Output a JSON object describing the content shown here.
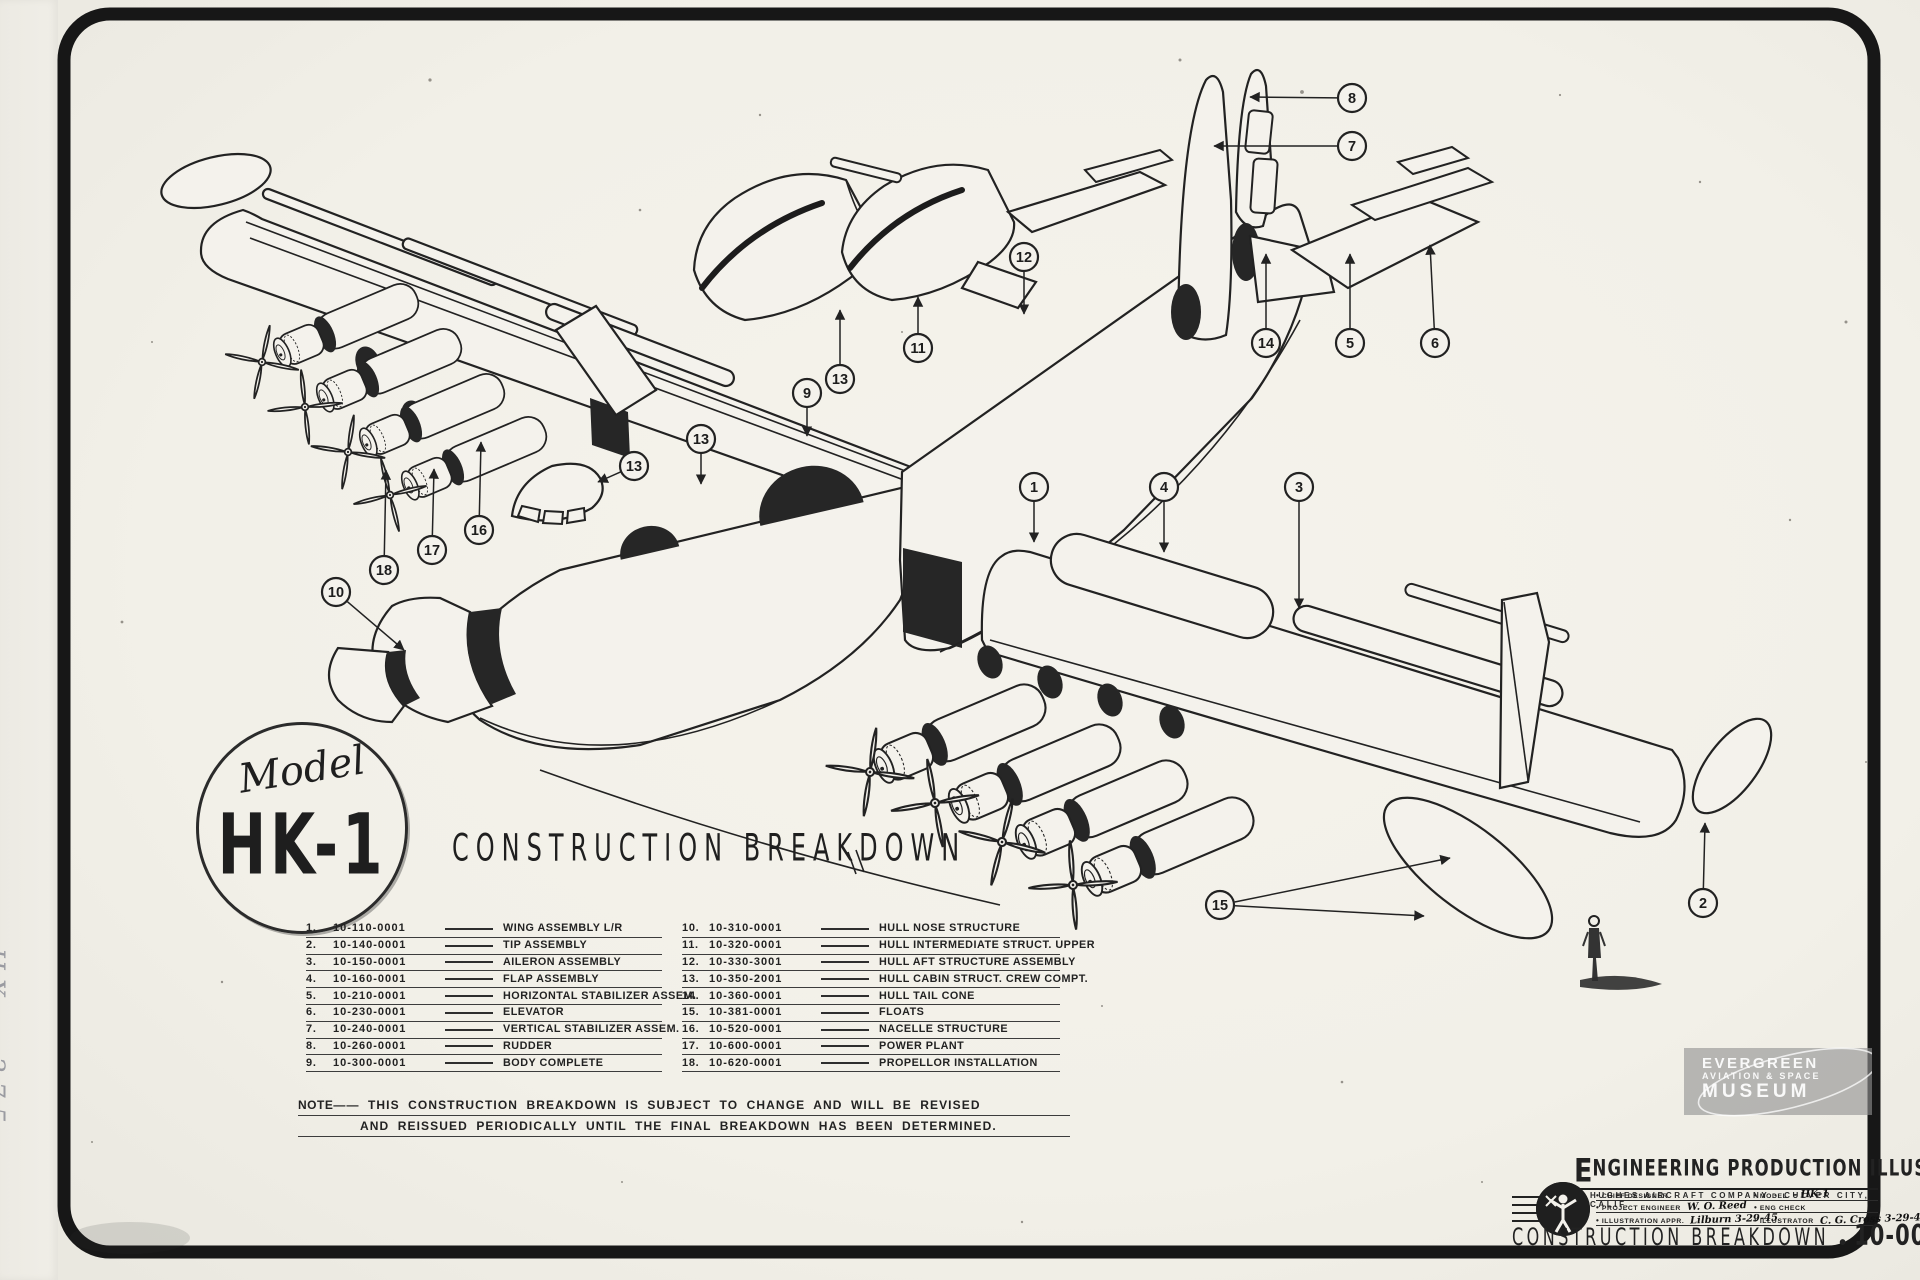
{
  "logo": {
    "model_label": "Model",
    "model_number": "HK-1"
  },
  "headline": "CONSTRUCTION BREAKDOWN",
  "parts_list": {
    "left": [
      {
        "num": "1.",
        "part": "10-110-0001",
        "name": "WING ASSEMBLY L/R"
      },
      {
        "num": "2.",
        "part": "10-140-0001",
        "name": "TIP ASSEMBLY"
      },
      {
        "num": "3.",
        "part": "10-150-0001",
        "name": "AILERON ASSEMBLY"
      },
      {
        "num": "4.",
        "part": "10-160-0001",
        "name": "FLAP ASSEMBLY"
      },
      {
        "num": "5.",
        "part": "10-210-0001",
        "name": "HORIZONTAL STABILIZER ASSEM."
      },
      {
        "num": "6.",
        "part": "10-230-0001",
        "name": "ELEVATOR"
      },
      {
        "num": "7.",
        "part": "10-240-0001",
        "name": "VERTICAL STABILIZER ASSEM."
      },
      {
        "num": "8.",
        "part": "10-260-0001",
        "name": "RUDDER"
      },
      {
        "num": "9.",
        "part": "10-300-0001",
        "name": "BODY COMPLETE"
      }
    ],
    "right": [
      {
        "num": "10.",
        "part": "10-310-0001",
        "name": "HULL NOSE STRUCTURE"
      },
      {
        "num": "11.",
        "part": "10-320-0001",
        "name": "HULL INTERMEDIATE STRUCT. UPPER"
      },
      {
        "num": "12.",
        "part": "10-330-3001",
        "name": "HULL AFT STRUCTURE ASSEMBLY"
      },
      {
        "num": "13.",
        "part": "10-350-2001",
        "name": "HULL CABIN STRUCT. CREW COMPT."
      },
      {
        "num": "14.",
        "part": "10-360-0001",
        "name": "HULL TAIL CONE"
      },
      {
        "num": "15.",
        "part": "10-381-0001",
        "name": "FLOATS"
      },
      {
        "num": "16.",
        "part": "10-520-0001",
        "name": "NACELLE STRUCTURE"
      },
      {
        "num": "17.",
        "part": "10-600-0001",
        "name": "POWER PLANT"
      },
      {
        "num": "18.",
        "part": "10-620-0001",
        "name": "PROPELLOR INSTALLATION"
      }
    ]
  },
  "note": {
    "label": "NOTE",
    "line1": "THIS CONSTRUCTION BREAKDOWN IS SUBJECT TO CHANGE AND WILL BE REVISED",
    "line2": "AND REISSUED PERIODICALLY UNTIL THE FINAL BREAKDOWN HAS BEEN DETERMINED."
  },
  "title_block": {
    "heading_initial": "E",
    "heading_rest": "NGINEERING PRODUCTION ILLUSTRATION",
    "subheading": "HUGHES AIRCRAFT COMPANY  ·  CULVER CITY, CALIF.",
    "fields_left": [
      {
        "label": "CHIEF DESIGNER",
        "value": ""
      },
      {
        "label": "PROJECT ENGINEER",
        "value": "W. O. Reed"
      },
      {
        "label": "ILLUSTRATION APPR.",
        "value": "Lilburn  3-29-45"
      }
    ],
    "fields_right": [
      {
        "label": "MODEL",
        "value": "- HK-1"
      },
      {
        "label": "ENG CHECK",
        "value": ""
      },
      {
        "label": "ILLUSTRATOR",
        "value": "C. G. Cross  3-29-43"
      }
    ],
    "footer_title": "CONSTRUCTION BREAKDOWN",
    "footer_dot": "•",
    "drawing_number": "10-000 0951-P"
  },
  "watermark": {
    "line1": "EVERGREEN",
    "line2": "AVIATION & SPACE",
    "line3": "MUSEUM"
  },
  "margin_note": "HX - 275",
  "callouts": [
    {
      "n": "1",
      "x": 1034,
      "y": 487,
      "targets": [
        [
          1034,
          542
        ]
      ]
    },
    {
      "n": "2",
      "x": 1703,
      "y": 903,
      "targets": [
        [
          1705,
          823
        ]
      ]
    },
    {
      "n": "3",
      "x": 1299,
      "y": 487,
      "targets": [
        [
          1299,
          608
        ]
      ]
    },
    {
      "n": "4",
      "x": 1164,
      "y": 487,
      "targets": [
        [
          1164,
          552
        ]
      ]
    },
    {
      "n": "5",
      "x": 1350,
      "y": 343,
      "targets": [
        [
          1350,
          254
        ]
      ]
    },
    {
      "n": "6",
      "x": 1435,
      "y": 343,
      "targets": [
        [
          1430,
          245
        ]
      ]
    },
    {
      "n": "7",
      "x": 1352,
      "y": 146,
      "targets": [
        [
          1214,
          146
        ]
      ]
    },
    {
      "n": "8",
      "x": 1352,
      "y": 98,
      "targets": [
        [
          1250,
          97
        ]
      ]
    },
    {
      "n": "9",
      "x": 807,
      "y": 393,
      "targets": [
        [
          807,
          436
        ]
      ]
    },
    {
      "n": "10",
      "x": 336,
      "y": 592,
      "targets": [
        [
          404,
          650
        ]
      ]
    },
    {
      "n": "11",
      "x": 918,
      "y": 348,
      "targets": [
        [
          918,
          297
        ]
      ]
    },
    {
      "n": "12",
      "x": 1024,
      "y": 257,
      "targets": [
        [
          1024,
          314
        ]
      ]
    },
    {
      "n": "13",
      "x": 840,
      "y": 379,
      "targets": [
        [
          840,
          310
        ]
      ]
    },
    {
      "n": "13",
      "x": 701,
      "y": 439,
      "targets": [
        [
          701,
          484
        ]
      ]
    },
    {
      "n": "13",
      "x": 634,
      "y": 466,
      "targets": [
        [
          598,
          482
        ]
      ]
    },
    {
      "n": "14",
      "x": 1266,
      "y": 343,
      "targets": [
        [
          1266,
          254
        ]
      ]
    },
    {
      "n": "15",
      "x": 1220,
      "y": 905,
      "targets": [
        [
          1450,
          858
        ],
        [
          1424,
          916
        ]
      ]
    },
    {
      "n": "16",
      "x": 479,
      "y": 530,
      "targets": [
        [
          481,
          442
        ]
      ]
    },
    {
      "n": "17",
      "x": 432,
      "y": 550,
      "targets": [
        [
          434,
          469
        ]
      ]
    },
    {
      "n": "18",
      "x": 384,
      "y": 570,
      "targets": [
        [
          386,
          470
        ]
      ]
    }
  ]
}
